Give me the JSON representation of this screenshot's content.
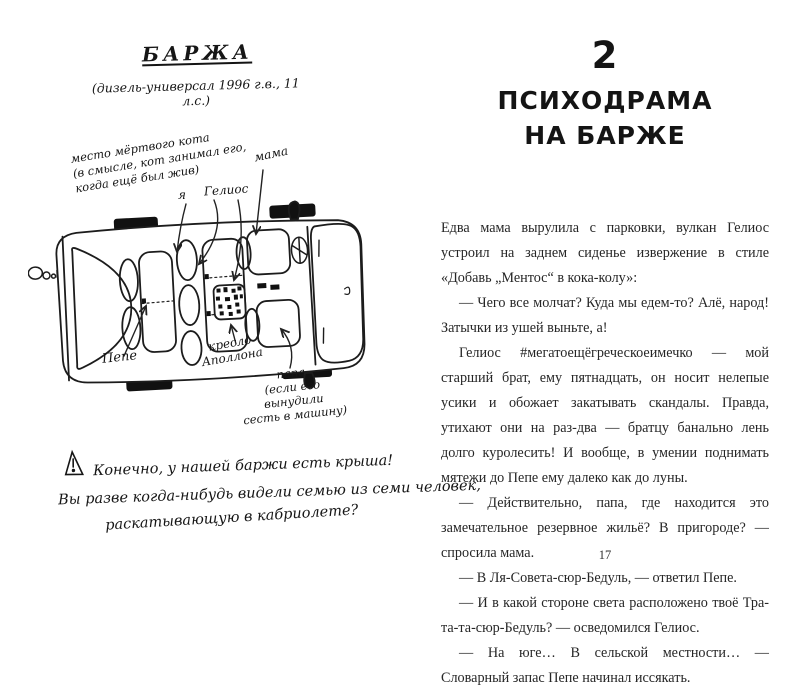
{
  "left_page": {
    "title": "БАРЖА",
    "subtitle": "(дизель-универсал 1996 г.в., 11 л.с.)",
    "diagram_labels": {
      "dead_cat": "место мёртвого кота\n(в смысле, кот занимал его,\nкогда ещё был жив)",
      "me": "я",
      "helios": "Гелиос",
      "mama": "мама",
      "pepe": "Пепе",
      "apollo_seat": "кресло\nАполлона",
      "papa": "папа\n(если его вынудили\nсесть в машину)"
    },
    "footnote": {
      "line1": "Конечно, у нашей баржи есть крыша!",
      "line2": "Вы разве когда-нибудь видели семью из семи человек,",
      "line3": "раскатывающую в кабриолете?"
    }
  },
  "right_page": {
    "chapter_number": "2",
    "chapter_title_line1": "ПСИХОДРАМА",
    "chapter_title_line2": "НА БАРЖЕ",
    "paragraphs": [
      "Едва мама вырулила с парковки, вулкан Гелиос устроил на заднем сиденье извержение в стиле «Добавь „Ментос“ в кока-колу»:",
      "— Чего все молчат? Куда мы едем-то? Алё, народ! Затычки из ушей выньте, а!",
      "Гелиос #мегатоещёгреческоеимечко — мой старший брат, ему пятнадцать, он носит нелепые усики и обожает закатывать скандалы. Правда, утихают они на раз-два — братцу банально лень долго куролесить! И вообще, в умении поднимать мятежи до Пепе ему далеко как до луны.",
      "— Действительно, папа, где находится это замечательное резервное жильё? В пригороде? — спросила мама.",
      "— В Ля-Совета-сюр-Бедуль, — ответил Пепе.",
      "— И в какой стороне света расположено твоё Тра-та-та-сюр-Бедуль? — осведомился Гелиос.",
      "— На юге… В сельской местности… — Словарный запас Пепе начинал иссякать."
    ],
    "page_number": "17"
  },
  "icons": {
    "warning": "hand-drawn exclamation triangle",
    "car_diagram": "top-view station-wagon sketch with seats, wheels, exhaust smoke"
  }
}
